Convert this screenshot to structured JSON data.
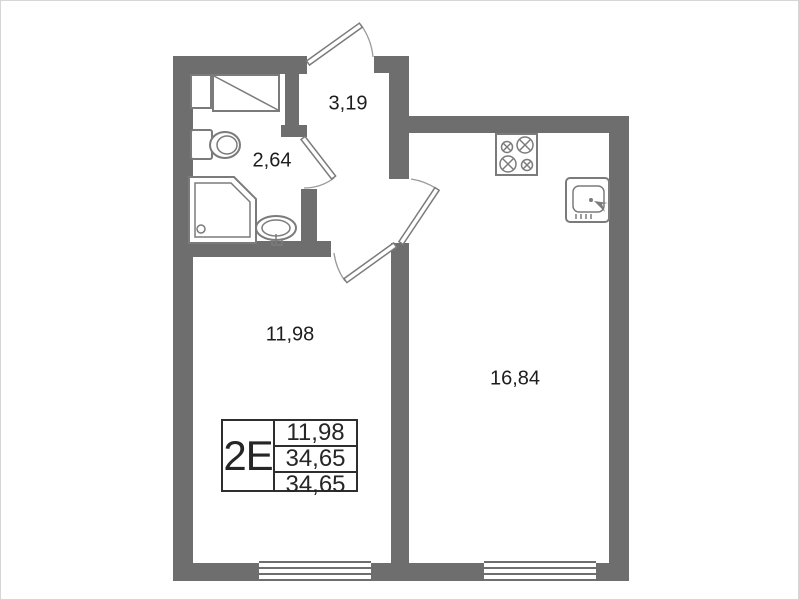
{
  "legend": {
    "code": "2E",
    "values": [
      "11,98",
      "34,65",
      "34,65"
    ]
  },
  "rooms": {
    "hallway": {
      "area": "3,19"
    },
    "bathroom": {
      "area": "2,64"
    },
    "living": {
      "area": "11,98"
    },
    "kitchen": {
      "area": "16,84"
    }
  },
  "icons": [
    "toilet-icon",
    "shower-tray-icon",
    "washbasin-icon",
    "vent-shaft-icon",
    "stove-icon",
    "kitchen-sink-icon",
    "door-swing-icon",
    "window-icon"
  ],
  "colors": {
    "wall": "#6e6e6e",
    "fixture_line": "#7b7b7b",
    "arc_line": "#9a9a9a",
    "text": "#1d1d1d",
    "table_border": "#2e2e2e",
    "background": "#ffffff"
  }
}
